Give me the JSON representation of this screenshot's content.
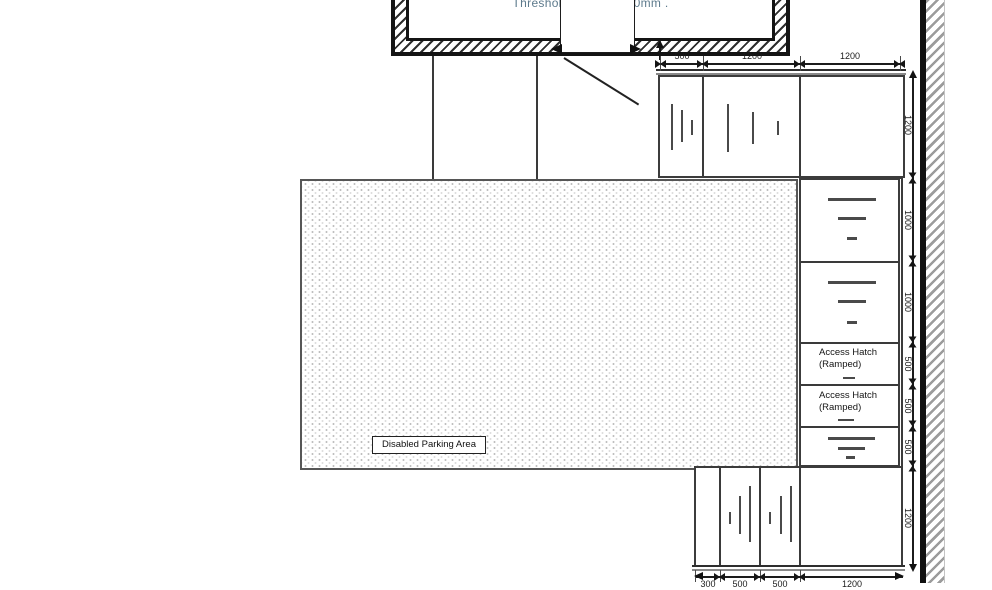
{
  "building": {
    "threshold_label": "Threshold Height +600mm ."
  },
  "parking": {
    "label": "Disabled Parking Area"
  },
  "panels": {
    "access_hatch_upper": {
      "line1": "Access Hatch",
      "line2": "(Ramped)"
    },
    "access_hatch_lower": {
      "line1": "Access Hatch",
      "line2": "(Ramped)"
    }
  },
  "dimensions": {
    "top": [
      "500",
      "1200",
      "1200"
    ],
    "bottom": [
      "300",
      "500",
      "500",
      "1200"
    ],
    "right": [
      "1200",
      "1000",
      "1000",
      "500",
      "500",
      "500",
      "1200"
    ]
  },
  "colors": {
    "line": "#1c1c1c",
    "wall": "#141414",
    "hatch_grey": "#9c9c9c",
    "stipple": "#bfbfbf",
    "threshold_text": "#5d7a8c"
  }
}
